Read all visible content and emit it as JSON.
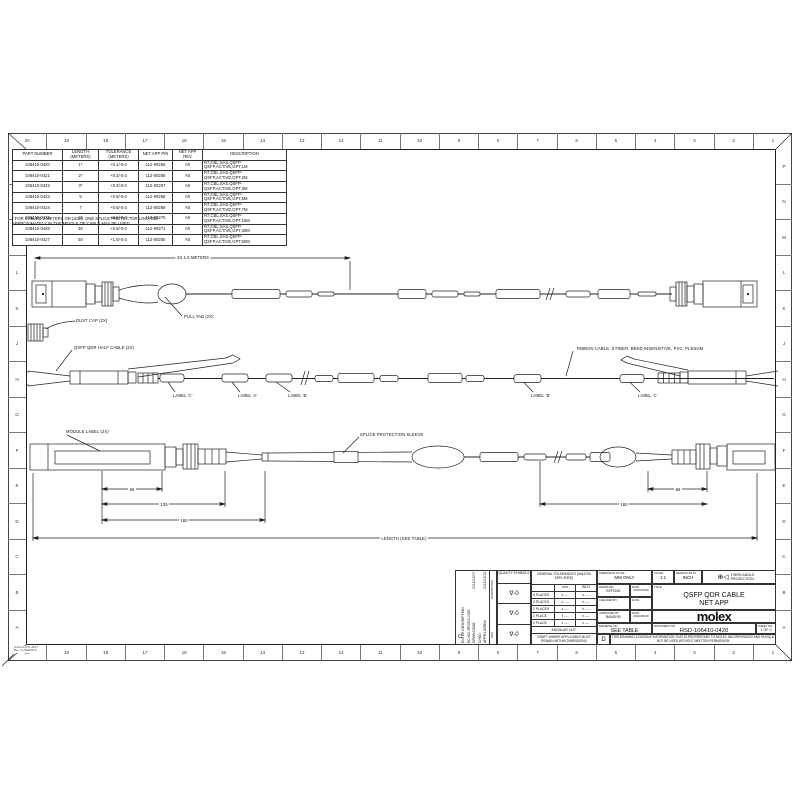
{
  "sheet": {
    "zone_numbers": [
      "20",
      "19",
      "18",
      "17",
      "16",
      "15",
      "14",
      "13",
      "12",
      "11",
      "10",
      "9",
      "8",
      "7",
      "6",
      "5",
      "4",
      "3",
      "2",
      "1"
    ],
    "zone_letters": [
      "P",
      "N",
      "M",
      "L",
      "K",
      "J",
      "H",
      "G",
      "F",
      "E",
      "D",
      "C",
      "B",
      "A"
    ],
    "frame_note_line1": "A-Frame D.P. AM-7",
    "frame_note_line2": "Rev. G 2012/01/17"
  },
  "parts_table": {
    "headers": [
      "PART NUMBER",
      "LENGTH (METERS)",
      "TOLERANCE (METERS)",
      "NET APP P/N",
      "NET APP REV",
      "DESCRIPTION"
    ],
    "rows": [
      [
        "106410-0420",
        "1*",
        "+0.1/-0.0",
        "112-00265",
        "A0",
        "R7,CBL,SAS,QSFP-QSFP,ACTIVE,OPT,1M"
      ],
      [
        "106410-0421",
        "2*",
        "+0.2/-0.0",
        "112-00266",
        "A0",
        "R7,CBL,SAS,QSFP-QSFP,ACTIVE,OPT,2M"
      ],
      [
        "106410-0422",
        "3*",
        "+0.3/-0.0",
        "112-00267",
        "A0",
        "R7,CBL,SAS,QSFP-QSFP,ACTIVE,OPT,3M"
      ],
      [
        "106410-0423",
        "5",
        "+0.5/-0.0",
        "112-00268",
        "A0",
        "R7,CBL,SAS,QSFP-QSFP,ACTIVE,OPT,5M"
      ],
      [
        "106410-0424",
        "7",
        "+0.5/-0.0",
        "112-00269",
        "A0",
        "R7,CBL,SAS,QSFP-QSFP,ACTIVE,OPT,7M"
      ],
      [
        "106410-0425",
        "15",
        "+0.5/-0.0",
        "112-00270",
        "A0",
        "R7,CBL,SAS,QSFP-QSFP,ACTIVE,OPT,15M"
      ],
      [
        "106410-0426",
        "30",
        "+0.5/-0.0",
        "112-00271",
        "A0",
        "R7,CBL,SAS,QSFP-QSFP,ACTIVE,OPT,30M"
      ],
      [
        "106410-0427",
        "50",
        "+1.0/-0.0",
        "112-00280",
        "A0",
        "R7,CBL,SAS,QSFP-QSFP,ACTIVE,OPT,50M"
      ]
    ],
    "footnote": "* FOR CABLES 3 METERS OR LESS, ONE SPLICE PROTECTOR LOCATED APPROXIMATELY IN THE MIDDLE OF CABLE MAY BE USED."
  },
  "callouts": {
    "dim_overall": "2X 1.5 METERS",
    "pull_tab": "PULL TAB (2X)",
    "dust_cap": "DUST CAP (2X)",
    "half_cable": "QSFP QDR HALF CABLE (2X)",
    "ribbon_cable": "RIBBON CABLE, 8 FIBER, BEND INSENSITIVE, PVC, PLENUM",
    "label_c_left": "LABEL 'C'",
    "label_a": "LABEL 'A'",
    "label_b_left": "LABEL 'B'",
    "label_b_right": "LABEL 'B'",
    "label_c_right": "LABEL 'C'",
    "module_label": "MODULE LABEL (2X)",
    "splice_sleeve": "SPLICE PROTECTION SLEEVE",
    "dim_65_left": "65",
    "dim_135": "135",
    "dim_180_left": "180",
    "dim_65_right": "65",
    "dim_180_right": "180",
    "length_note": "LENGTH (SEE TABLE)"
  },
  "title_block": {
    "revision": {
      "rev_letter": "C",
      "rev_label": "REV",
      "description_label": "DESCRIPTION",
      "entries": [
        [
          "ENTER DESCRIPTION",
          ""
        ],
        [
          "EC NO: RF2903-0339",
          ""
        ],
        [
          "DRWN:DM82",
          "2012/12/07"
        ],
        [
          "CHKD:",
          ""
        ],
        [
          "APPR:LIGREA",
          "2012/12/13"
        ]
      ]
    },
    "quality": {
      "label": "QUALITY SYMBOLS",
      "symbols": [
        "∇-0",
        "∇-0",
        "∇-0"
      ]
    },
    "tolerances": {
      "title": "GENERAL TOLERANCES (UNLESS SPECIFIED)",
      "col_mm": "mm",
      "col_inch": "INCH",
      "rows": [
        [
          "4 PLACES",
          "± ----",
          "± ----"
        ],
        [
          "3 PLACES",
          "± ----",
          "± ----"
        ],
        [
          "2 PLACES",
          "± ----",
          "± ----"
        ],
        [
          "1 PLACE",
          "± ----",
          "± ----"
        ],
        [
          "0 PLACE",
          "± ----",
          "± ----"
        ]
      ],
      "angular": "ANGULAR ±1/2°",
      "draft_note": "DRAFT WHERE APPLICABLE MUST REMAIN WITHIN DIMENSIONS"
    },
    "info": {
      "dimension_style_label": "DIMENSION STYLE",
      "dimension_style": "MM ONLY",
      "scale_label": "SCALE",
      "scale": "1:1",
      "design_units_label": "DESIGN UNITS",
      "design_units": "INCH",
      "projection_symbols": "⊕◁",
      "projection_label": "THIRD ANGLE PROJECTION",
      "drawn_by_label": "DRAWN BY",
      "drawn_by": "EEFUNG",
      "date_label": "DATE",
      "drawn_date": "2012/03/30",
      "checked_by_label": "CHECKED BY",
      "checked_by": "",
      "checked_date": "",
      "title_label": "TITLE",
      "title_line1": "QSFP QDR CABLE",
      "title_line2": "NET APP",
      "approved_by_label": "APPROVED BY",
      "approved_by": "BANDREI",
      "approved_date": "2012/06/18",
      "material_label": "MATERIAL NO.",
      "material": "SEE TABLE",
      "document_label": "DOCUMENT NO.",
      "document_no": "RSD-106410-0420",
      "sheet_label": "SHEET NO.",
      "sheet_no": "1 OF 2",
      "logo": "molex",
      "size_letter": "D",
      "proprietary": "THIS DRAWING CONTAINS INFORMATION THAT IS PROPRIETARY TO MOLEX INCORPORATED AND SHOULD NOT BE USED WITHOUT WRITTEN PERMISSION"
    }
  }
}
